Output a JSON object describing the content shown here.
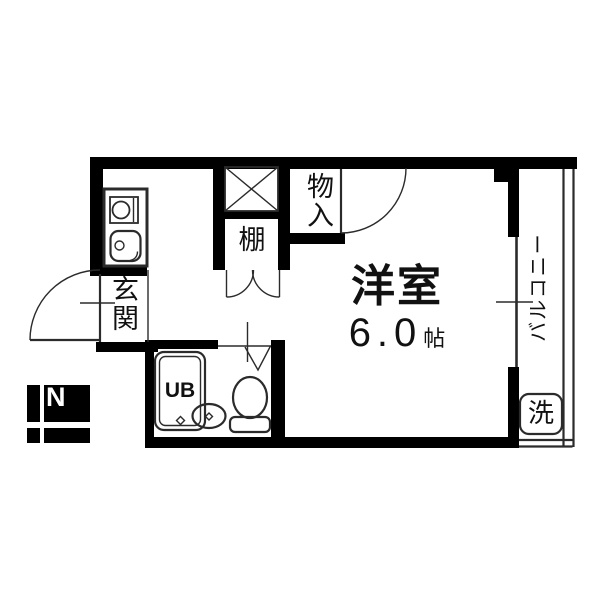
{
  "colors": {
    "background": "#ffffff",
    "wall": "#000000",
    "line": "#2b2b2b",
    "text": "#111111",
    "compass_text": "#ffffff"
  },
  "compass": {
    "north_label": "N"
  },
  "rooms": {
    "western_room": {
      "name": "洋室",
      "size_value": "6.0",
      "size_unit": "帖"
    },
    "entrance": {
      "name": "玄関"
    },
    "storage": {
      "name": "物入"
    },
    "shelf": {
      "name": "棚"
    },
    "balcony": {
      "name": "バルコニー"
    },
    "unit_bath": {
      "label": "UB"
    },
    "laundry": {
      "label": "洗"
    }
  }
}
